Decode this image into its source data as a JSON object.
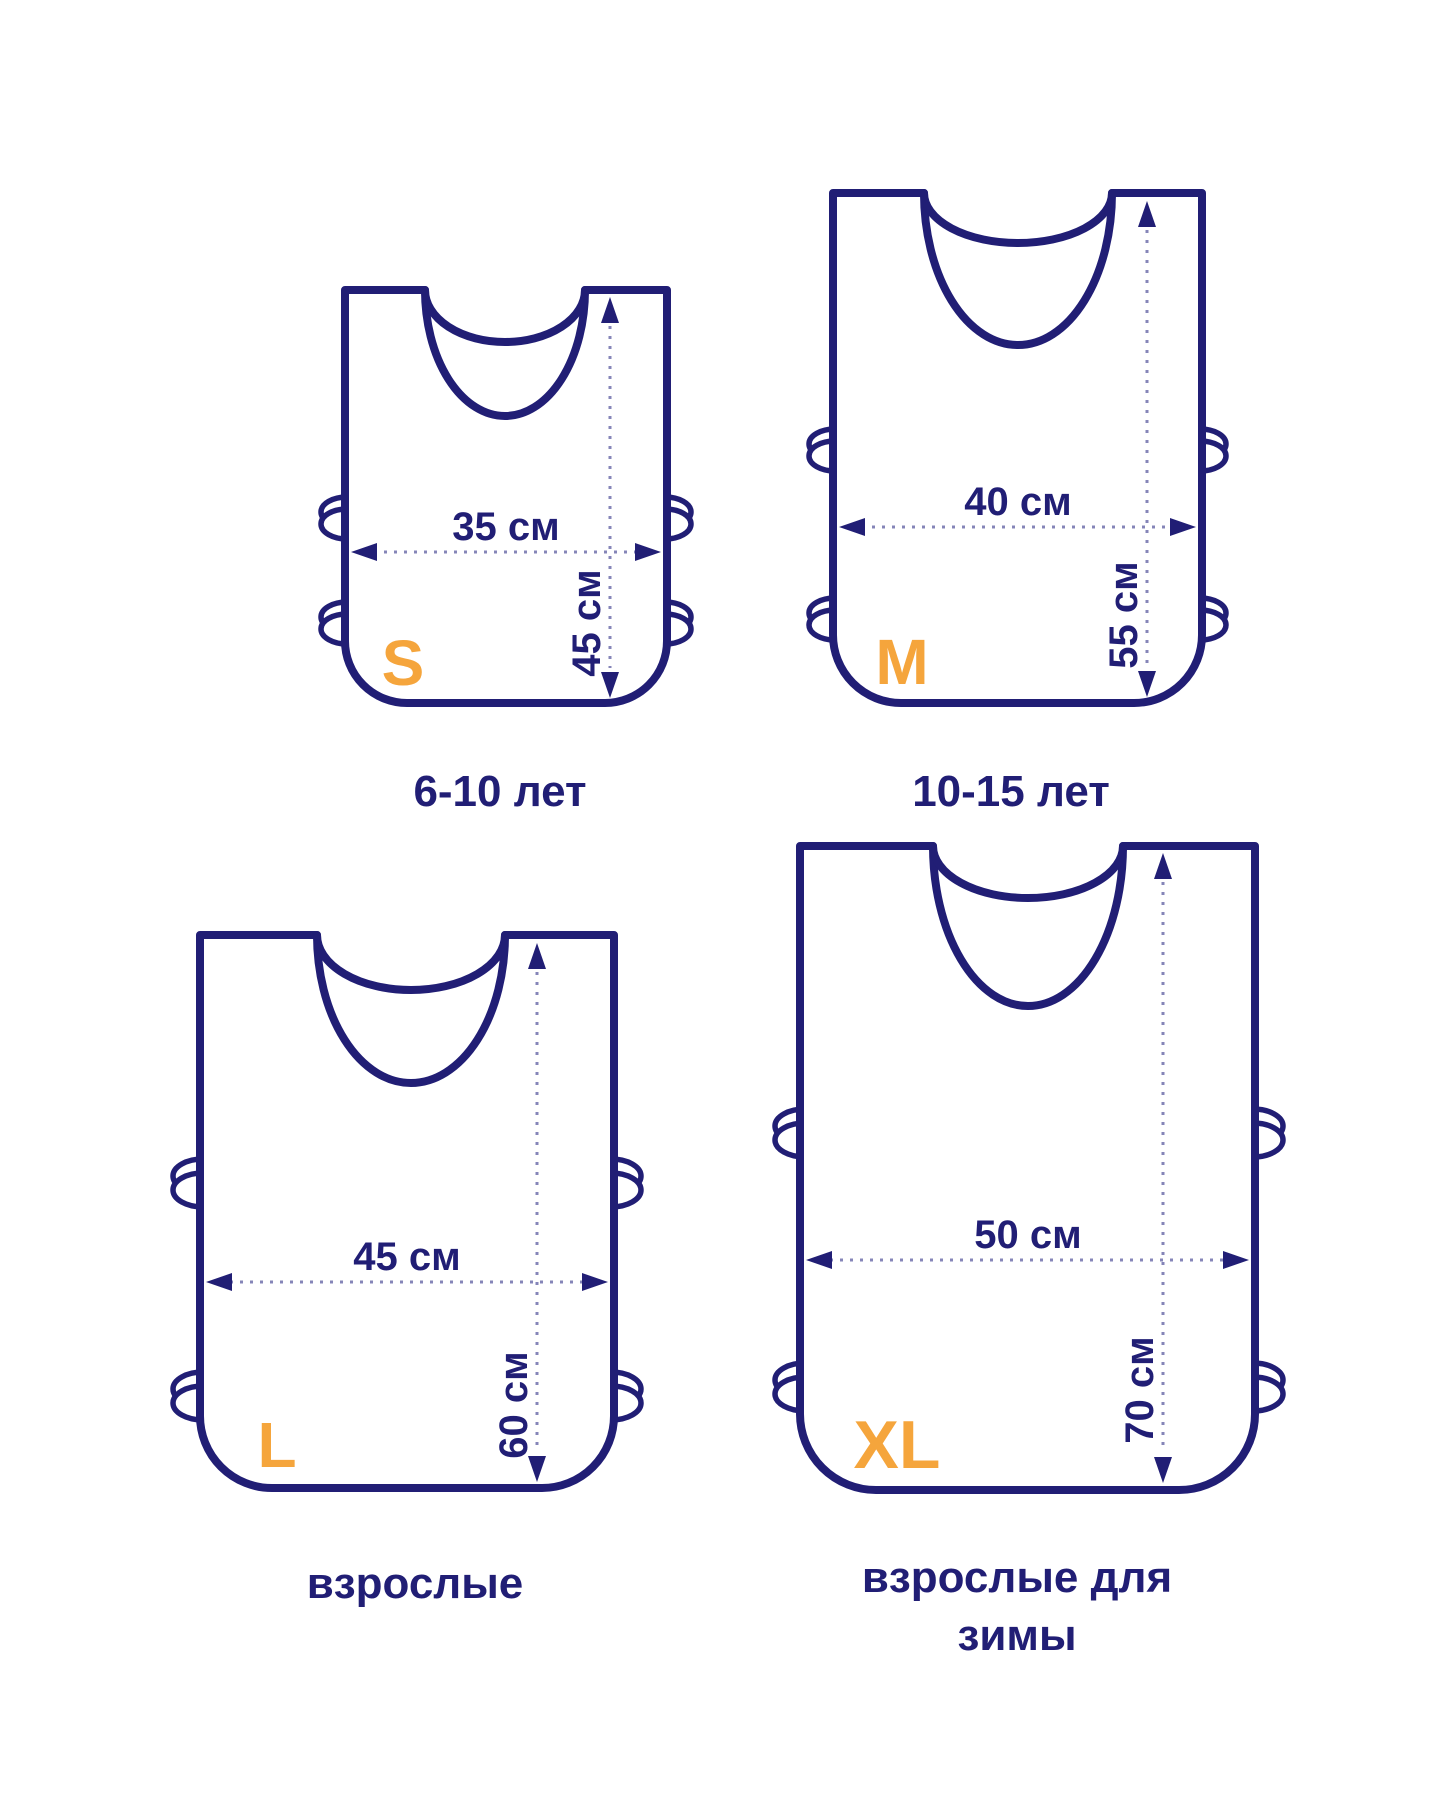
{
  "colors": {
    "navy": "#211e75",
    "orange": "#f5a53c",
    "dots": "#8585b8",
    "background": "#ffffff"
  },
  "sizes": [
    {
      "code": "S",
      "width_cm": 35,
      "height_cm": 45,
      "width_label": "35 см",
      "height_label": "45 см",
      "caption_lines": [
        "6-10 лет"
      ]
    },
    {
      "code": "M",
      "width_cm": 40,
      "height_cm": 55,
      "width_label": "40 см",
      "height_label": "55 см",
      "caption_lines": [
        "10-15 лет"
      ]
    },
    {
      "code": "L",
      "width_cm": 45,
      "height_cm": 60,
      "width_label": "45 см",
      "height_label": "60 см",
      "caption_lines": [
        "взрослые"
      ]
    },
    {
      "code": "XL",
      "width_cm": 50,
      "height_cm": 70,
      "width_label": "50 см",
      "height_label": "70 см",
      "caption_lines": [
        "взрослые для",
        "зимы"
      ]
    }
  ]
}
